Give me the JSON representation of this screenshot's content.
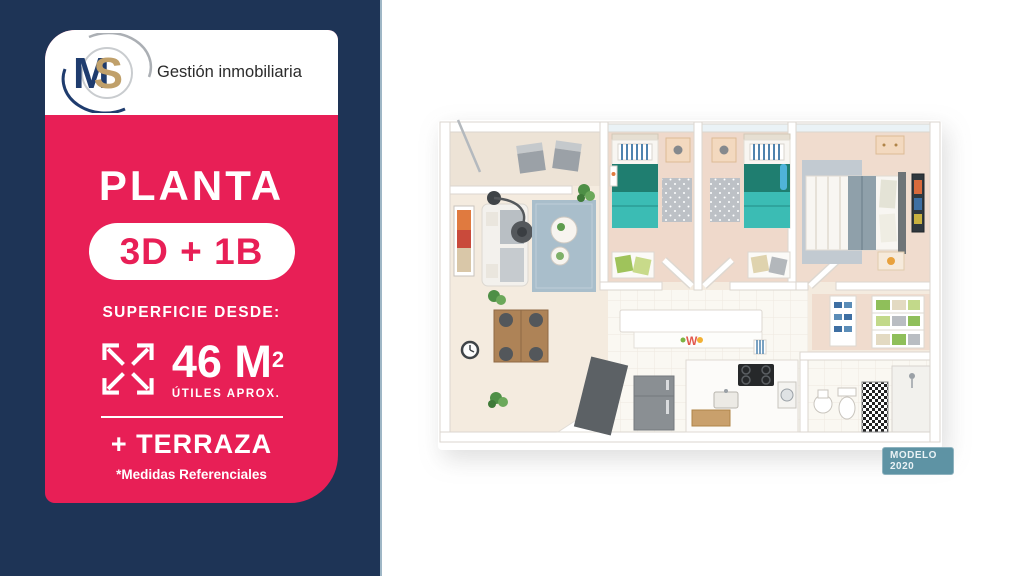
{
  "colors": {
    "navy": "#1E3456",
    "pink": "#E81F56",
    "gold": "#C0A06A",
    "white": "#FFFFFF",
    "badge_teal": "#5E93A4",
    "floor_cream": "#F4EBDF",
    "floor_bedroom": "#EFD9CB",
    "teal_blanket": "#3BBCB4",
    "green_blanket": "#1F7E70"
  },
  "left_panel": {
    "logo": {
      "letter_m": "M",
      "letter_s": "S",
      "brand_text": "Gestión inmobiliaria"
    },
    "card": {
      "title": "PLANTA",
      "type_badge": "3D + 1B",
      "surface_label": "SUPERFICIE DESDE:",
      "area_value": "46 M",
      "area_superscript": "2",
      "area_note": "ÚTILES APROX.",
      "extra_feature": "+ TERRAZA",
      "disclaimer": "*Medidas Referenciales",
      "expand_icon": "expand-arrows-icon"
    }
  },
  "floor_plan": {
    "model_badge": "MODELO 2020"
  }
}
